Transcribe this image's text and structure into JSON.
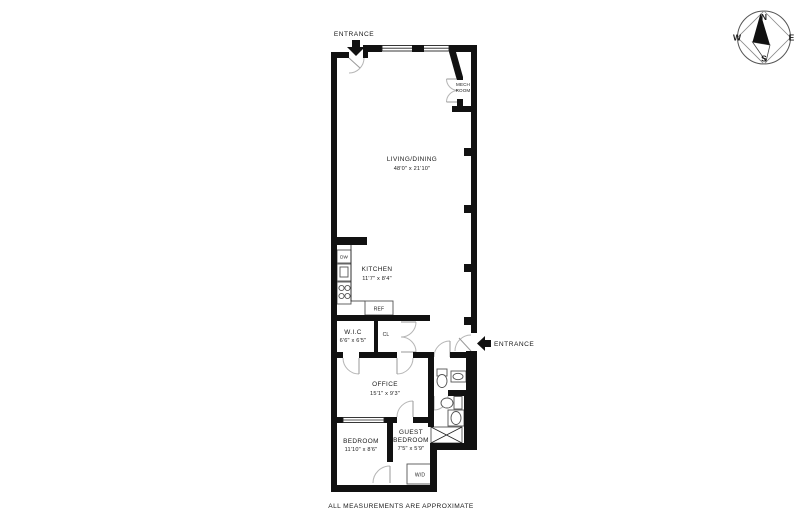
{
  "meta": {
    "disclaimer": "ALL MEASUREMENTS ARE APPROXIMATE"
  },
  "labels": {
    "entrance_top": "ENTRANCE",
    "entrance_side": "ENTRANCE"
  },
  "rooms": {
    "living_dining": {
      "name": "LIVING/DINING",
      "dims": "48'0\" x 21'10\""
    },
    "kitchen": {
      "name": "KITCHEN",
      "dims": "11'7\" x 8'4\""
    },
    "wic": {
      "name": "W.I.C",
      "dims": "6'6\" x 6'5\""
    },
    "office": {
      "name": "OFFICE",
      "dims": "15'1\" x 9'3\""
    },
    "bedroom": {
      "name": "BEDROOM",
      "dims": "11'10\" x 8'6\""
    },
    "guest_bedroom": {
      "name_line1": "GUEST",
      "name_line2": "BEDROOM",
      "dims": "7'5\" x 5'9\""
    },
    "mech_room": {
      "name_line1": "MECH",
      "name_line2": "ROOM"
    }
  },
  "fixtures": {
    "dishwasher": "DW",
    "refrigerator": "REF",
    "closet": "CL",
    "washer_dryer": "W/D"
  },
  "compass": {
    "north": "N",
    "east": "E",
    "south": "S",
    "west": "W"
  },
  "colors": {
    "wall": "#111111",
    "background": "#ffffff",
    "door_arc": "#b5b5b5"
  }
}
